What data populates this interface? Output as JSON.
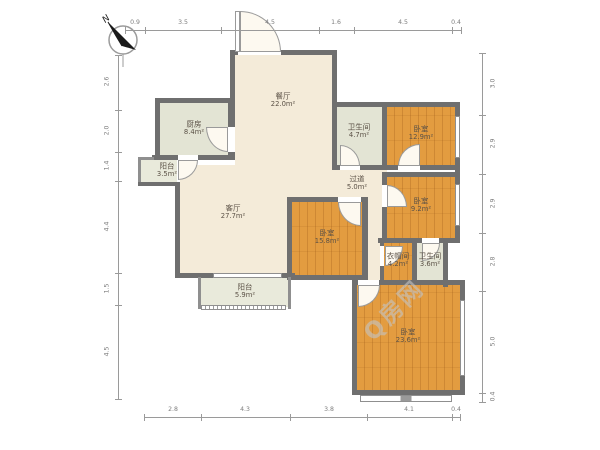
{
  "compass": {
    "label": "N"
  },
  "watermark": {
    "text": "Q房网"
  },
  "rooms": [
    {
      "id": "dining",
      "name": "餐厅",
      "area": "22.0m²"
    },
    {
      "id": "kitchen",
      "name": "厨房",
      "area": "8.4m²"
    },
    {
      "id": "balcony-small",
      "name": "阳台",
      "area": "3.5m²"
    },
    {
      "id": "living",
      "name": "客厅",
      "area": "27.7m²"
    },
    {
      "id": "balcony",
      "name": "阳台",
      "area": "5.9m²"
    },
    {
      "id": "bath-main",
      "name": "卫生间",
      "area": "4.7m²"
    },
    {
      "id": "bedroom-ne",
      "name": "卧室",
      "area": "12.9m²"
    },
    {
      "id": "hallway",
      "name": "过道",
      "area": "5.0m²"
    },
    {
      "id": "bedroom-e",
      "name": "卧室",
      "area": "9.2m²"
    },
    {
      "id": "bedroom-c",
      "name": "卧室",
      "area": "15.8m²"
    },
    {
      "id": "closet",
      "name": "衣帽间",
      "area": "4.2m²"
    },
    {
      "id": "bath-small",
      "name": "卫生间",
      "area": "3.6m²"
    },
    {
      "id": "bedroom-s",
      "name": "卧室",
      "area": "23.6m²"
    }
  ],
  "dimensions": {
    "top": [
      "0.9",
      "3.5",
      "4.5",
      "1.6",
      "4.5",
      "0.4"
    ],
    "bottom": [
      "2.8",
      "4.3",
      "3.8",
      "4.1",
      "0.4"
    ],
    "left": [
      "2.6",
      "2.0",
      "1.4",
      "4.4",
      "1.5",
      "4.5"
    ],
    "right": [
      "3.0",
      "2.9",
      "2.9",
      "2.8",
      "5.0",
      "0.4"
    ]
  },
  "colors": {
    "wall": "#6f6f6f",
    "wood_floor": "#e39c40",
    "tile_floor": "#e3e4d4",
    "main_floor": "#f4ebd9",
    "dim_text": "#7d7d7d"
  }
}
